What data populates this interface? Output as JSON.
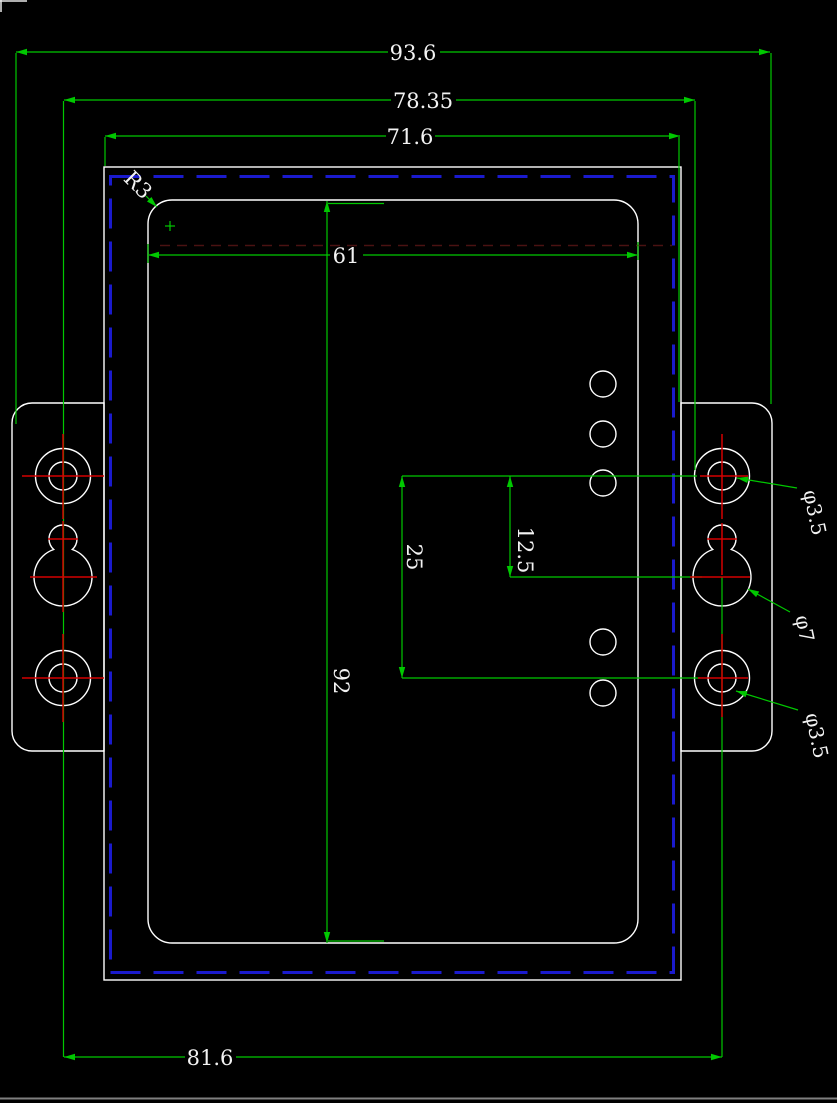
{
  "drawing": {
    "type": "cad-dimensioned-enclosure-front-view",
    "background": "#000000",
    "colors": {
      "dimension_lines": "#00c800",
      "outline": "#ffffff",
      "hidden_layer": "#1a1acd",
      "center_marks": "#d40000",
      "dark_hidden_line": "#4a1212",
      "screen_border": "#7f7f7f"
    },
    "dimensions": {
      "overall_width": "93.6",
      "flange_span_width": "78.35",
      "body_width": "71.6",
      "lid_width": "61",
      "lid_height": "92",
      "hole_pitch": "25",
      "hole_offset": "12.5",
      "mounting_hole_span": "81.6",
      "corner_radius": "R3",
      "top_hole_diameter": "φ3.5",
      "keyhole_slot_diameter": "φ7",
      "bottom_hole_diameter": "φ3.5"
    }
  }
}
